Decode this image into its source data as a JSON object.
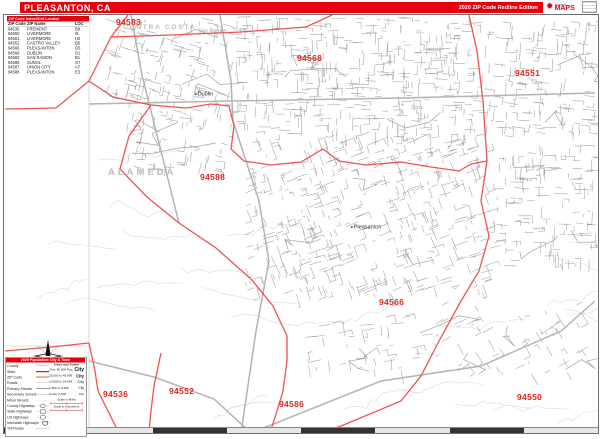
{
  "header": {
    "title": "PLEASANTON, CA",
    "edition": "2020 ZIP Code Redline Edition",
    "logo": {
      "top": "Market",
      "main": "MAPS"
    }
  },
  "zip_index": {
    "header": "ZIP Code Index/Grid Locator",
    "columns": [
      "ZIP Code",
      "ZIP Name",
      "LOC"
    ],
    "rows": [
      [
        "94536",
        "FREMONT",
        "B8"
      ],
      [
        "94550",
        "LIVERMORE",
        "I5"
      ],
      [
        "94551",
        "LIVERMORE",
        "H2"
      ],
      [
        "94552",
        "CASTRO VALLEY",
        "B5"
      ],
      [
        "94566",
        "PLEASANTON",
        "G5"
      ],
      [
        "94568",
        "DUBLIN",
        "D1"
      ],
      [
        "94583",
        "SAN RAMON",
        "B1"
      ],
      [
        "94586",
        "SUNOL",
        "G7"
      ],
      [
        "94587",
        "UNION CITY",
        "A7"
      ],
      [
        "94588",
        "PLEASANTON",
        "E3"
      ]
    ]
  },
  "map": {
    "county_labels": [
      {
        "text": "CONTRA COSTA",
        "x": 119,
        "y": 9,
        "size": 6.5,
        "ls": 1.8
      },
      {
        "text": "ALAMEDA",
        "x": 104,
        "y": 152,
        "size": 9.5,
        "ls": 3
      }
    ],
    "city_labels": [
      {
        "text": "San Ramon",
        "x": 194,
        "y": 13,
        "dim": true,
        "marker": false
      },
      {
        "text": "Dublin",
        "x": 191,
        "y": 76,
        "dim": false,
        "marker": true
      },
      {
        "text": "Pleasanton",
        "x": 347,
        "y": 209,
        "dim": false,
        "marker": true
      }
    ],
    "zip_labels": [
      {
        "text": "94583",
        "x": 112,
        "y": 2
      },
      {
        "text": "94568",
        "x": 293,
        "y": 38
      },
      {
        "text": "94551",
        "x": 511,
        "y": 53
      },
      {
        "text": "94588",
        "x": 196,
        "y": 157
      },
      {
        "text": "94566",
        "x": 375,
        "y": 282
      },
      {
        "text": "94536",
        "x": 99,
        "y": 374
      },
      {
        "text": "94552",
        "x": 165,
        "y": 371
      },
      {
        "text": "94586",
        "x": 275,
        "y": 384
      },
      {
        "text": "94550",
        "x": 513,
        "y": 377
      }
    ]
  },
  "legend": {
    "header": "2020 Population: City & Town",
    "cities_header": "Cities and Towns",
    "lines": [
      {
        "label": "County",
        "symbol": "county"
      },
      {
        "label": "State",
        "symbol": "state"
      },
      {
        "label": "ZIP Code",
        "symbol": "zip"
      },
      {
        "label": "Roads",
        "symbol": "road"
      },
      {
        "label": "Primary Streets",
        "symbol": "primary"
      },
      {
        "label": "Secondary Streets",
        "symbol": "secondary"
      },
      {
        "label": "Minor Streets",
        "symbol": "minor"
      },
      {
        "label": "County Highways",
        "symbol": "county-hwy"
      },
      {
        "label": "State Highways",
        "symbol": "state-hwy"
      },
      {
        "label": "US Highways",
        "symbol": "us-hwy"
      },
      {
        "label": "Interstate Highways",
        "symbol": "interstate"
      },
      {
        "label": "Toll Roads",
        "symbol": "toll"
      }
    ],
    "city_tiers": [
      {
        "range": "Over 50,000 Pop.",
        "sample": "City"
      },
      {
        "range": "25,000 to 49,999",
        "sample": "City"
      },
      {
        "range": "10,000 to 24,999",
        "sample": "City"
      },
      {
        "range": "2,500 to 9,999",
        "sample": "City"
      },
      {
        "range": "Under 2,500",
        "sample": "City"
      }
    ],
    "scales": [
      "Scale in Miles",
      "Scale in Kilometers"
    ]
  },
  "colors": {
    "accent_red": "#e8000d",
    "boundary_red": "#ef5350",
    "zip_label_red": "#e0261f",
    "street_gray": "#8f8f8f",
    "contour_gray": "#dcdcdc"
  }
}
